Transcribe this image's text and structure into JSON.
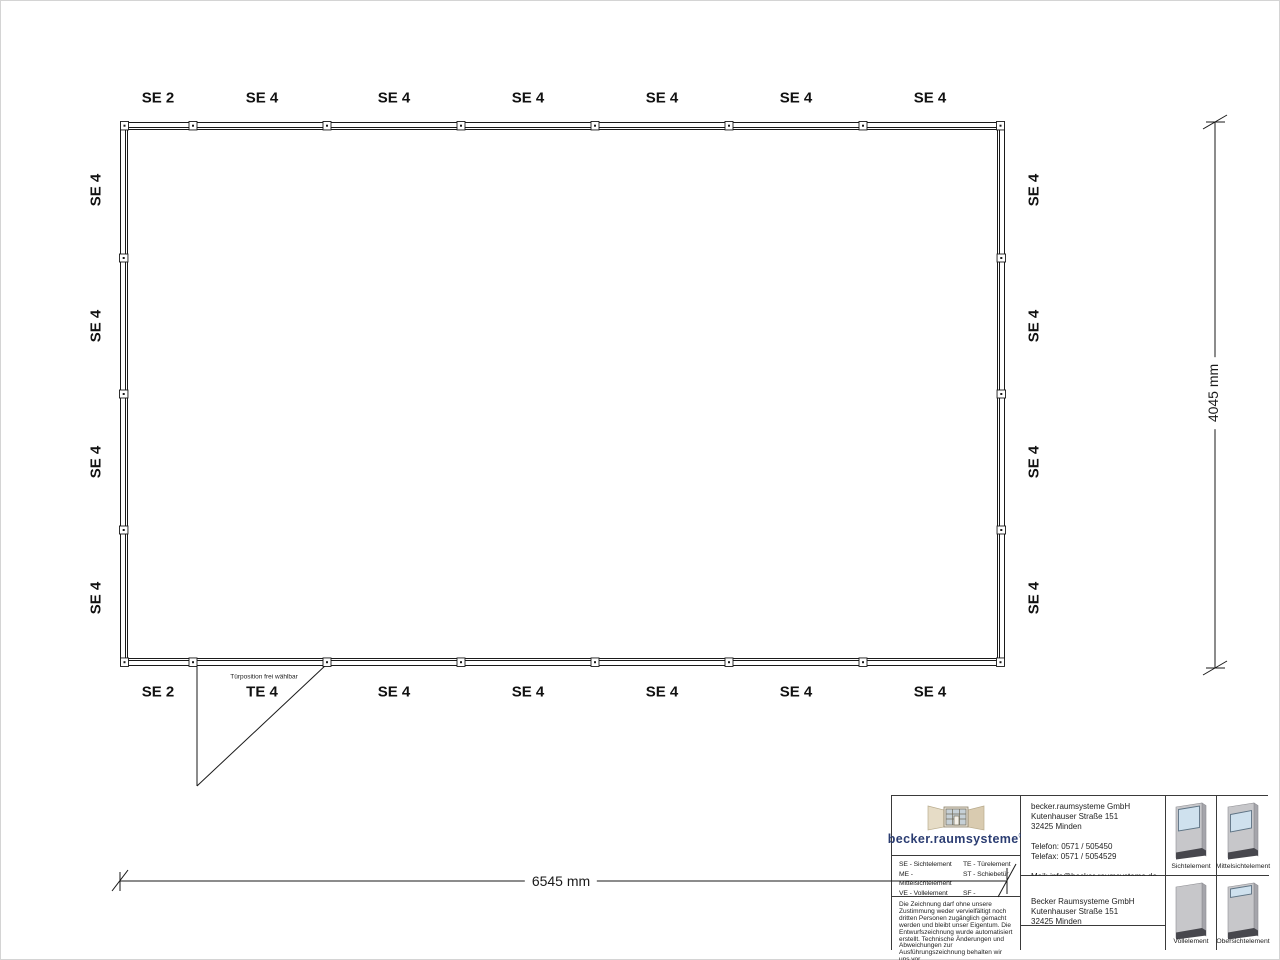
{
  "drawing": {
    "top_wall_labels": [
      "SE 2",
      "SE 4",
      "SE 4",
      "SE 4",
      "SE 4",
      "SE 4",
      "SE 4"
    ],
    "bottom_wall_labels": [
      "SE 2",
      "TE 4",
      "SE 4",
      "SE 4",
      "SE 4",
      "SE 4",
      "SE 4"
    ],
    "left_wall_labels": [
      "SE 4",
      "SE 4",
      "SE 4",
      "SE 4"
    ],
    "right_wall_labels": [
      "SE 4",
      "SE 4",
      "SE 4",
      "SE 4"
    ],
    "door_note": "Türposition frei wählbar",
    "width_dimension": "6545 mm",
    "height_dimension": "4045 mm"
  },
  "title_block": {
    "logo_text": "becker.raumsysteme",
    "logo_registered": "®",
    "legend": {
      "col1": [
        "SE - Sichtelement",
        "ME - Mittelsichtelement",
        "VE - Vollelement",
        "OE - Obersichtelement"
      ],
      "col2": [
        "TE - Türelement",
        "ST - Schiebetür",
        "SF - Schiebefenster",
        "DKF - Drehkippfenster"
      ]
    },
    "disclaimer": "Die Zeichnung darf ohne unsere Zustimmung weder vervielfältigt noch dritten Personen zugänglich gemacht werden und bleibt unser Eigentum. Die Entwurfszeichnung wurde automatisiert erstellt. Technische Änderungen und Abweichungen zur Ausführungszeichnung behalten wir uns vor.",
    "contact": {
      "company": "becker.raumsysteme GmbH",
      "street": "Kutenhauser Straße 151",
      "city": "32425 Minden",
      "phone": "Telefon: 0571 / 505450",
      "fax": "Telefax: 0571 / 5054529",
      "mail": "Mail: info@becker-raumsysteme.de",
      "web": "Web: www.becker-raumsysteme.de"
    },
    "manufacturer": {
      "company": "Becker Raumsysteme GmbH",
      "street": "Kutenhauser Straße 151",
      "city": "32425 Minden"
    },
    "elements": {
      "sicht": "Sichtelement",
      "mittel": "Mittelsichtelement",
      "voll": "Vollelement",
      "ober": "Obersichtelement"
    }
  },
  "colors": {
    "line": "#1a1a1a",
    "logo_blue": "#2b3d72",
    "panel_gray": "#c7c7ca",
    "glass_blue": "#cfe1ee",
    "base_dark": "#47474d",
    "logo_beige": "#e3d7c0"
  }
}
